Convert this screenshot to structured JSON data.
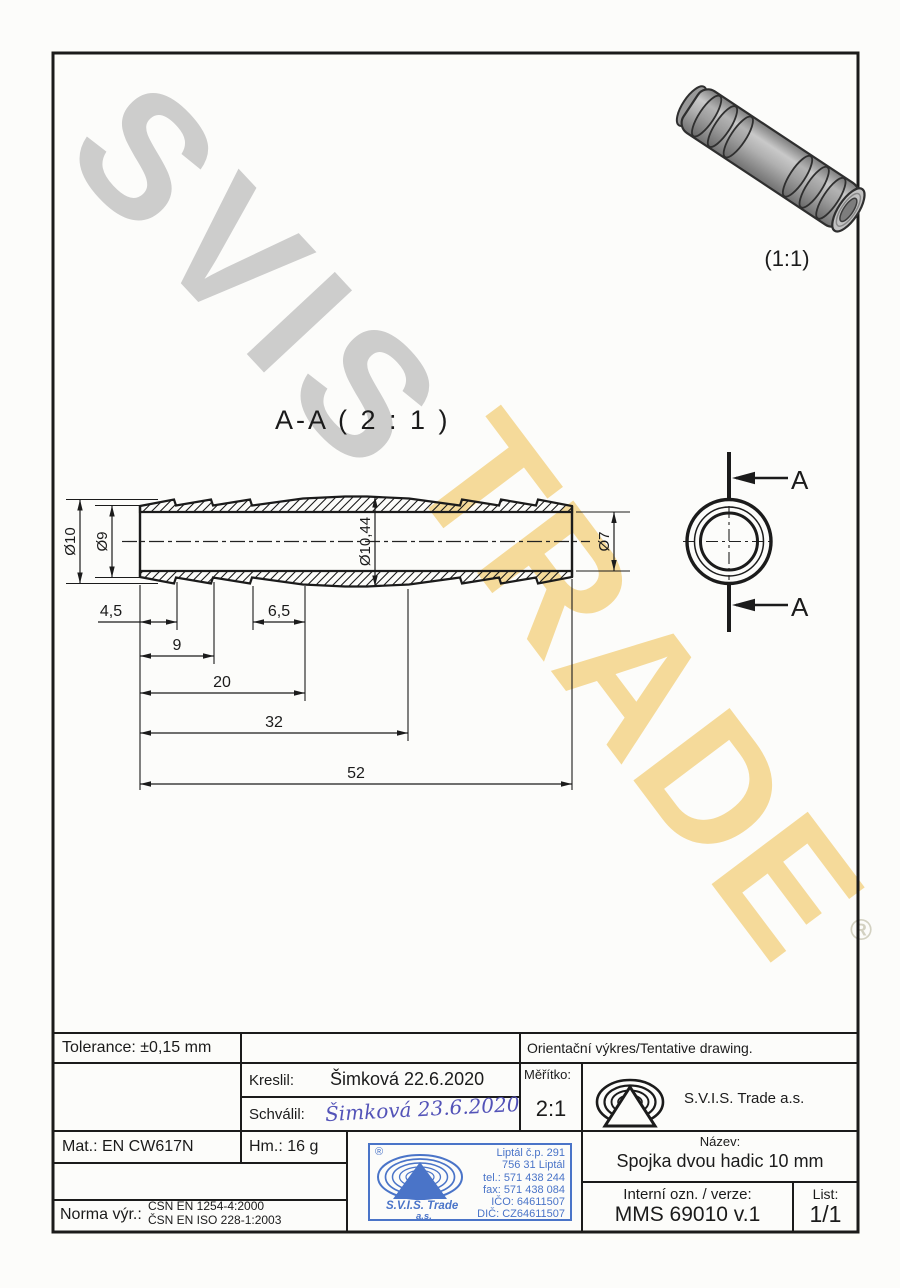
{
  "watermark": {
    "word_top": "SVIS",
    "word_bottom": "TRADE",
    "registered_symbol": "®",
    "gray": "#c8c8c8",
    "yellow": "#f4d58a"
  },
  "photo": {
    "scale_label": "(1:1)"
  },
  "drawing": {
    "view_label": "A-A ( 2 : 1 )",
    "cut_label": "A",
    "dims": {
      "od10": "Ø10",
      "od9": "Ø9",
      "od_mid": "Ø10,44",
      "od7": "Ø7",
      "l45": "4,5",
      "l9": "9",
      "l65": "6,5",
      "l20": "20",
      "l32": "32",
      "l52": "52"
    }
  },
  "titleblock": {
    "tolerance": "Tolerance: ±0,15 mm",
    "tentative": "Orientační výkres/Tentative drawing.",
    "kreslil_label": "Kreslil:",
    "kreslil_value": "Šimková 22.6.2020",
    "schvalil_label": "Schválil:",
    "schvalil_value": "Šimková 23.6.2020",
    "meritko_label": "Měřítko:",
    "meritko_value": "2:1",
    "company": "S.V.I.S. Trade a.s.",
    "mat": "Mat.: EN CW617N",
    "hm": "Hm.: 16 g",
    "nazev_label": "Název:",
    "nazev_value": "Spojka dvou hadic 10 mm",
    "interni_label": "Interní ozn. / verze:",
    "interni_value": "MMS 69010 v.1",
    "list_label": "List:",
    "list_value": "1/1",
    "norma_label": "Norma výr.:",
    "norma_line1": "ČSN EN 1254-4:2000",
    "norma_line2": "ČSN EN ISO 228-1:2003"
  },
  "stamp": {
    "registered": "®",
    "company": "S.V.I.S. Trade",
    "suffix": "a.s.",
    "lines": [
      "Liptál č.p. 291",
      "756 31 Liptál",
      "tel.: 571 438 244",
      "fax: 571 438 084",
      "IČO: 64611507",
      "DIČ: CZ64611507"
    ],
    "color": "#4a74c8"
  },
  "colors": {
    "ink": "#1b1b1b",
    "paper": "#fcfcfa",
    "signature_blue": "#5353b8",
    "stamp_blue": "#4a74c8"
  }
}
